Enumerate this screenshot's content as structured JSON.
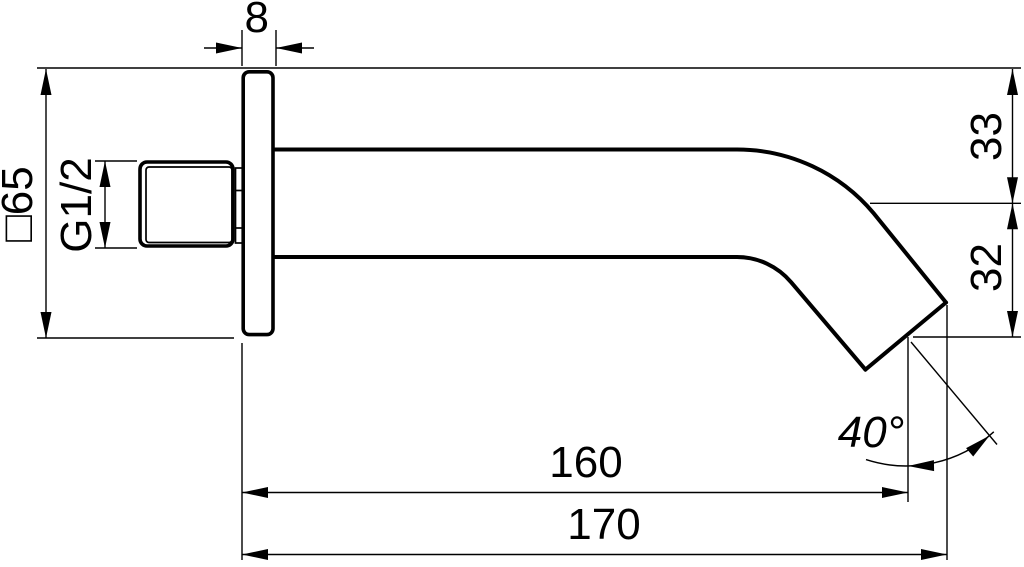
{
  "page": {
    "background": "#ffffff",
    "ink": "#000000"
  },
  "drawing": {
    "labels": {
      "flange_thickness": "8",
      "flange_square": "□65",
      "thread_size": "G1/2",
      "upper_offset": "33",
      "lower_offset": "32",
      "spout_reach": "160",
      "overall_reach": "170",
      "outlet_angle": "40°"
    }
  }
}
